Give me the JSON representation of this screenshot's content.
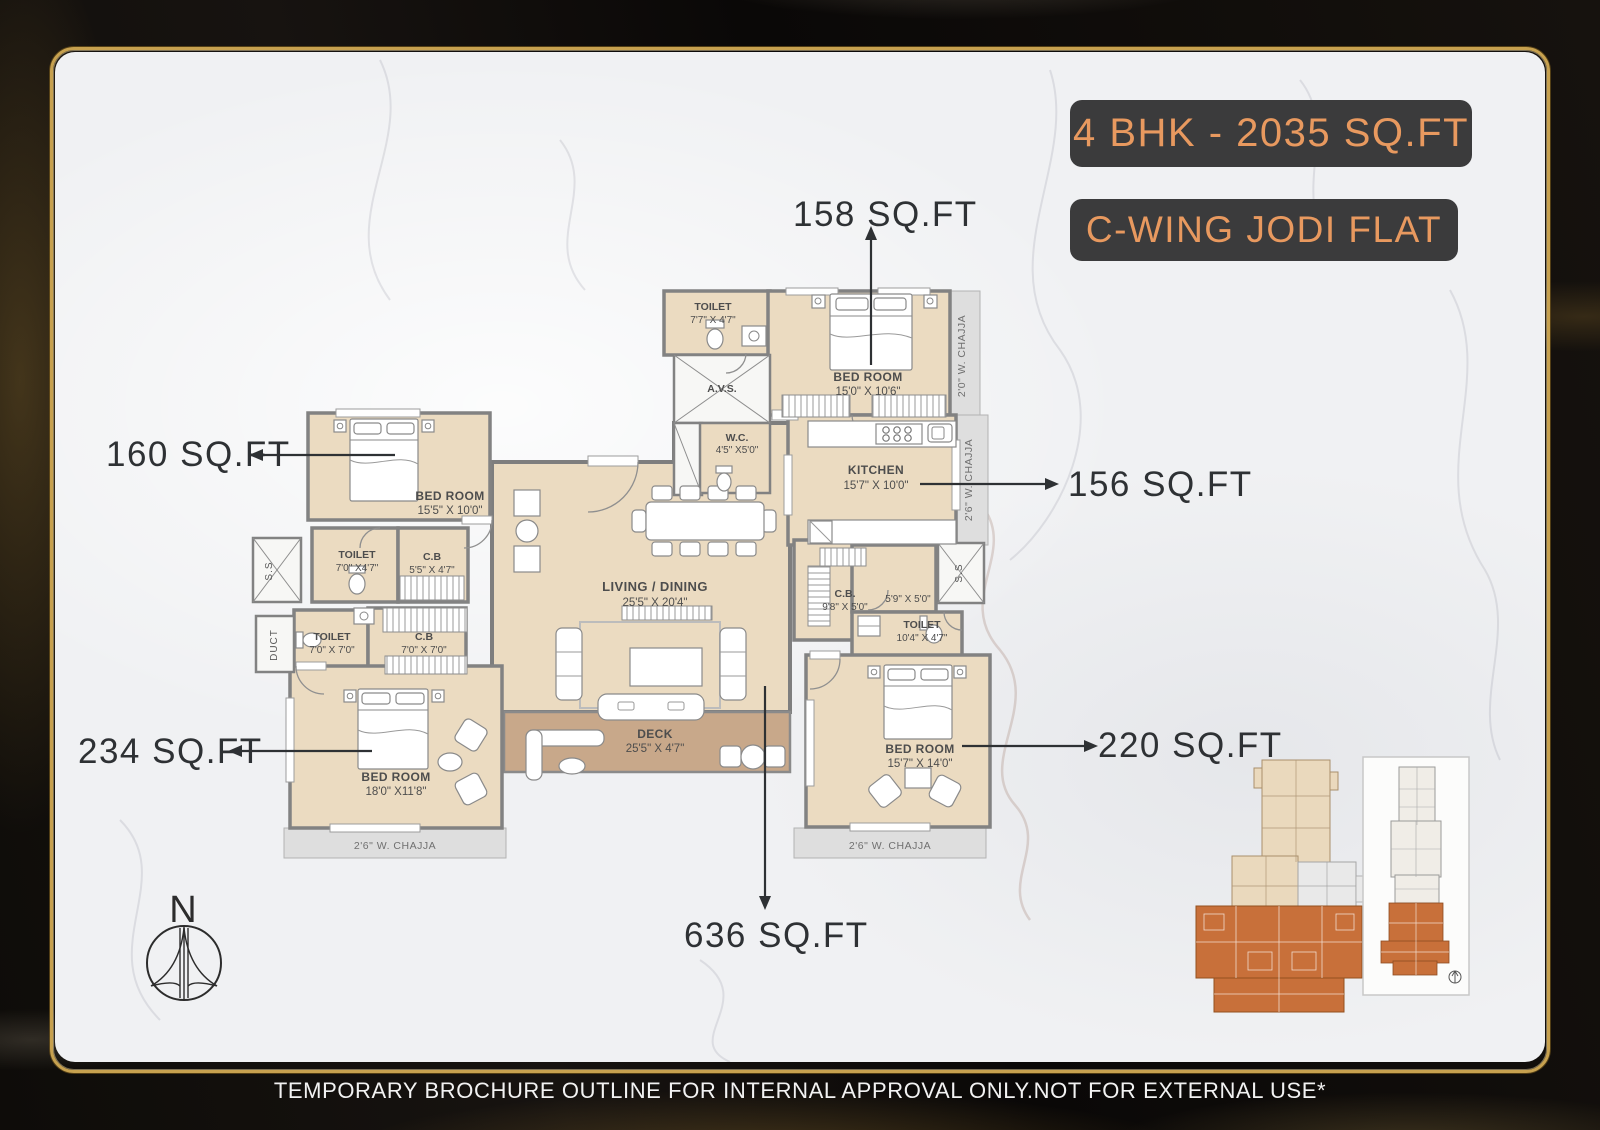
{
  "header": {
    "badge_primary": "4 BHK - 2035 SQ.FT",
    "badge_secondary": "C-WING JODI FLAT"
  },
  "floor_plan": {
    "rooms": {
      "toilet_top": {
        "label": "TOILET",
        "dims": "7'7\" X 4'7\""
      },
      "avs": {
        "label": "A.V.S."
      },
      "wc": {
        "label": "W.C.",
        "dims": "4'5\" X5'0\""
      },
      "bedroom_top": {
        "label": "BED ROOM",
        "dims": "15'0\" X 10'6\""
      },
      "kitchen": {
        "label": "KITCHEN",
        "dims": "15'7\" X 10'0\""
      },
      "bedroom_left": {
        "label": "BED ROOM",
        "dims": "15'5\" X 10'0\""
      },
      "toilet_left_upper": {
        "label": "TOILET",
        "dims": "7'0\" X4'7\""
      },
      "cb_left_upper": {
        "label": "C.B",
        "dims": "5'5\" X 4'7\""
      },
      "toilet_left_lower": {
        "label": "TOILET",
        "dims": "7'0\" X 7'0\""
      },
      "cb_left_lower": {
        "label": "C.B",
        "dims": "7'0\" X 7'0\""
      },
      "living_dining": {
        "label": "LIVING / DINING",
        "dims": "25'5\" X 20'4\""
      },
      "deck": {
        "label": "DECK",
        "dims": "25'5\" X 4'7\""
      },
      "cb_right": {
        "label": "C.B.",
        "dims": "9'8\" X 5'0\""
      },
      "store_right": {
        "dims": "5'9\" X 5'0\""
      },
      "toilet_right": {
        "label": "TOILET",
        "dims": "10'4\" X 4'7\""
      },
      "bedroom_bottom_left": {
        "label": "BED ROOM",
        "dims": "18'0\" X11'8\""
      },
      "bedroom_bottom_right": {
        "label": "BED ROOM",
        "dims": "15'7\" X 14'0\""
      }
    },
    "chajja": {
      "top_right": "2'0\" W. CHAJJA",
      "kitchen_right": "2'6\" W. CHAJJA",
      "bottom_left": "2'6\" W. CHAJJA",
      "bottom_right": "2'6\" W. CHAJJA"
    },
    "shafts": {
      "ss": "S.S",
      "duct": "DUCT"
    },
    "area_callouts": {
      "bedroom_top": "158 SQ.FT",
      "bedroom_left": "160 SQ.FT",
      "kitchen": "156 SQ.FT",
      "bedroom_bottom_left": "234 SQ.FT",
      "bedroom_bottom_right": "220 SQ.FT",
      "living_deck": "636 SQ.FT"
    }
  },
  "compass": {
    "north_label": "N"
  },
  "footer": {
    "disclaimer": "TEMPORARY BROCHURE OUTLINE FOR INTERNAL APPROVAL ONLY.NOT FOR EXTERNAL USE*"
  },
  "colors": {
    "accent_orange": "#E8995F",
    "badge_bg": "#3B3B3C",
    "room_fill": "#EBDBC1",
    "deck_fill": "#C8A88A",
    "wall_gray": "#828282",
    "chajja_fill": "#DEDEDE",
    "keyplan_highlight": "#C8703A",
    "frame_gold": "#C7A14F",
    "text_ink": "#2E3134"
  }
}
